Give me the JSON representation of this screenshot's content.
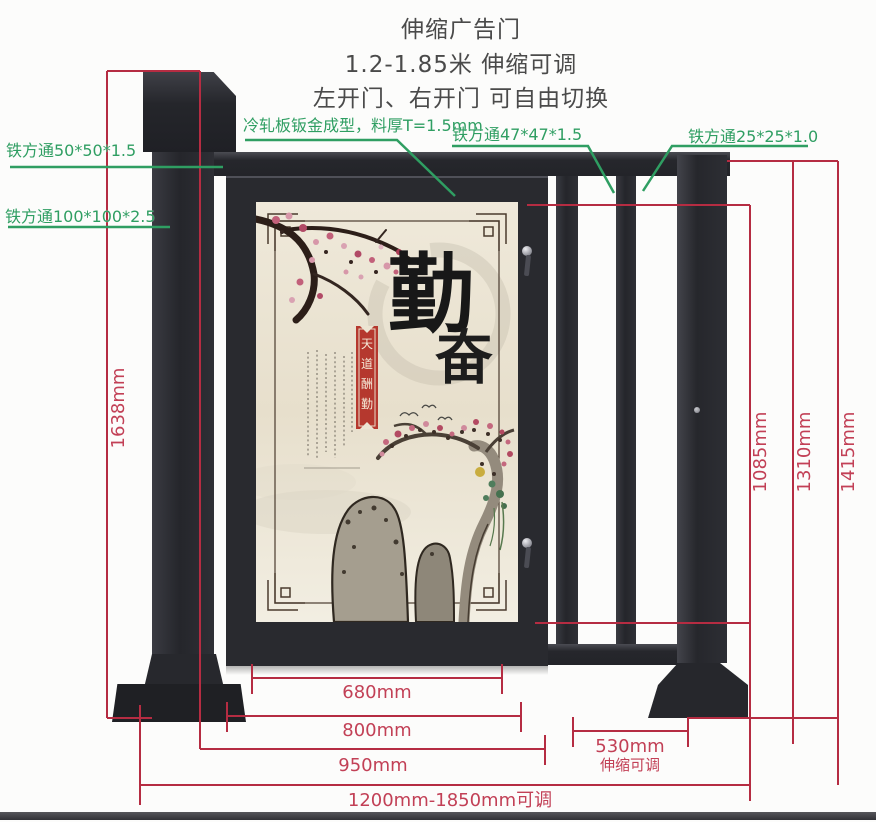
{
  "title": {
    "line1": "伸缩广告门",
    "line2": "1.2-1.85米 伸缩可调",
    "line3": "左开门、右开门 可自由切换"
  },
  "part_labels": {
    "sheet_metal": "冷轧板钣金成型，料厚T=1.5mm",
    "tube_50": "铁方通50*50*1.5",
    "tube_100": "铁方通100*100*2.5",
    "tube_47": "铁方通47*47*1.5",
    "tube_25": "铁方通25*25*1.0"
  },
  "dimensions": {
    "total_height": "1638mm",
    "door_height": "1085mm",
    "mid_height": "1310mm",
    "frame_height": "1415mm",
    "panel_width": "680mm",
    "door_width": "800mm",
    "leaf_width": "950mm",
    "extension_width": "530mm",
    "extension_note": "伸缩可调",
    "total_width": "1200mm-1850mm可调"
  },
  "poster": {
    "main_char_1": "勤",
    "main_char_2": "奋",
    "banner_chars": [
      "天",
      "道",
      "酬",
      "勤"
    ]
  },
  "colors": {
    "metal_dark": "#2a2b30",
    "dimension_red": "#b52c42",
    "label_green": "#2f9e62",
    "poster_cream": "#ece4d2",
    "banner_red": "#b5382e"
  }
}
